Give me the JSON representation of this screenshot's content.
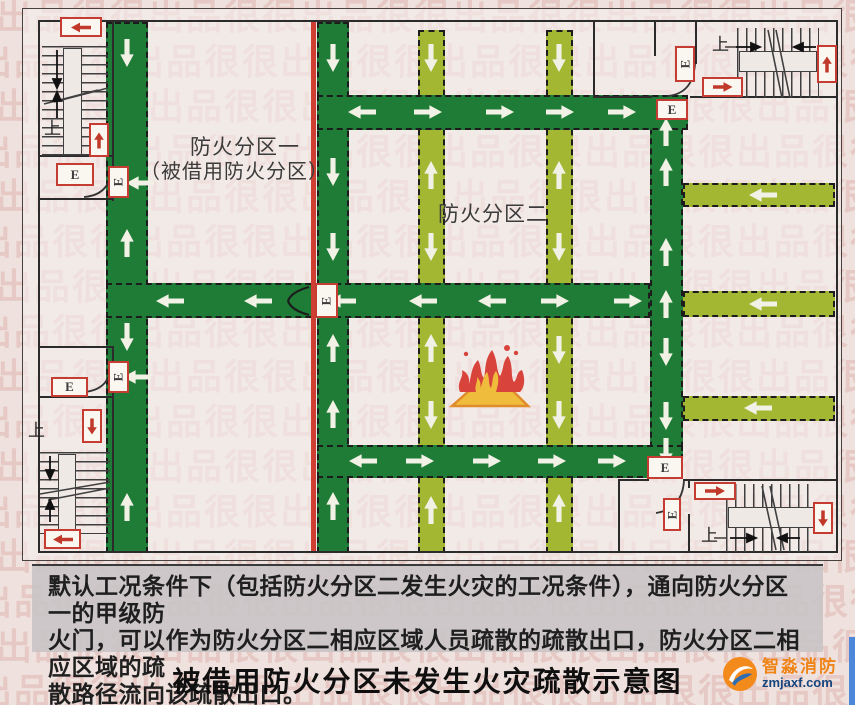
{
  "watermark": {
    "chars": "出品很很"
  },
  "caption": {
    "text": "被借用防火分区未发生火灾疏散示意图"
  },
  "note": {
    "lines": [
      "默认工况条件下（包括防火分区二发生火灾的工况条件），通向防火分区一的甲级防",
      "火门，可以作为防火分区二相应区域人员疏散的疏散出口，防火分区二相应区域的疏",
      "散路径流向该疏散出口。"
    ]
  },
  "logo": {
    "name": "智淼消防",
    "domain": "zmjaxf.com"
  },
  "plan": {
    "labels": {
      "zone1_line1": "防火分区一",
      "zone1_line2": "（被借用防火分区）",
      "zone2": "防火分区二",
      "up": "上",
      "exit": "E"
    },
    "colors": {
      "corridor_green": "#1f7c36",
      "corridor_olive": "#a4b733",
      "firewall_red": "#cf3e33",
      "sign_red": "#c0392b",
      "arrow_white": "#f2f1e6"
    },
    "firewall": {
      "x": 311,
      "y": 20,
      "w": 5,
      "h": 533
    },
    "corridors": [
      {
        "id": "olive-vertical-1",
        "color": "olive",
        "x": 418,
        "y": 30,
        "w": 27,
        "h": 523
      },
      {
        "id": "olive-vertical-2",
        "color": "olive",
        "x": 546,
        "y": 30,
        "w": 27,
        "h": 523
      },
      {
        "id": "olive-stub-upper",
        "color": "olive",
        "x": 683,
        "y": 183,
        "w": 152,
        "h": 24
      },
      {
        "id": "olive-stub-middle",
        "color": "olive",
        "x": 683,
        "y": 291,
        "w": 152,
        "h": 26
      },
      {
        "id": "olive-stub-lower",
        "color": "olive",
        "x": 683,
        "y": 396,
        "w": 152,
        "h": 25
      },
      {
        "id": "left-vertical",
        "color": "green",
        "x": 106,
        "y": 22,
        "w": 42,
        "h": 531
      },
      {
        "id": "firewall-vertical",
        "color": "green",
        "x": 317,
        "y": 22,
        "w": 32,
        "h": 531
      },
      {
        "id": "right-vertical",
        "color": "green",
        "x": 650,
        "y": 98,
        "w": 33,
        "h": 380
      },
      {
        "id": "top-horizontal",
        "color": "green",
        "x": 317,
        "y": 95,
        "w": 371,
        "h": 35
      },
      {
        "id": "middle-horizontal",
        "color": "green",
        "x": 106,
        "y": 283,
        "w": 544,
        "h": 35
      },
      {
        "id": "bottom-horizontal",
        "color": "green",
        "x": 317,
        "y": 445,
        "w": 366,
        "h": 33
      }
    ],
    "flow_arrows": [
      {
        "x": 127,
        "y": 53,
        "dir": "down"
      },
      {
        "x": 127,
        "y": 243,
        "dir": "up"
      },
      {
        "x": 127,
        "y": 337,
        "dir": "down"
      },
      {
        "x": 127,
        "y": 507,
        "dir": "up"
      },
      {
        "x": 140,
        "y": 183,
        "dir": "left"
      },
      {
        "x": 137,
        "y": 377,
        "dir": "left"
      },
      {
        "x": 333,
        "y": 58,
        "dir": "down"
      },
      {
        "x": 333,
        "y": 172,
        "dir": "down"
      },
      {
        "x": 333,
        "y": 247,
        "dir": "down"
      },
      {
        "x": 333,
        "y": 348,
        "dir": "up"
      },
      {
        "x": 333,
        "y": 414,
        "dir": "up"
      },
      {
        "x": 333,
        "y": 506,
        "dir": "up"
      },
      {
        "x": 362,
        "y": 112,
        "dir": "left"
      },
      {
        "x": 428,
        "y": 112,
        "dir": "right"
      },
      {
        "x": 500,
        "y": 112,
        "dir": "right"
      },
      {
        "x": 560,
        "y": 112,
        "dir": "right"
      },
      {
        "x": 622,
        "y": 112,
        "dir": "right"
      },
      {
        "x": 666,
        "y": 132,
        "dir": "up"
      },
      {
        "x": 666,
        "y": 172,
        "dir": "up"
      },
      {
        "x": 666,
        "y": 252,
        "dir": "up"
      },
      {
        "x": 666,
        "y": 304,
        "dir": "up"
      },
      {
        "x": 666,
        "y": 352,
        "dir": "down"
      },
      {
        "x": 666,
        "y": 416,
        "dir": "down"
      },
      {
        "x": 666,
        "y": 452,
        "dir": "down"
      },
      {
        "x": 170,
        "y": 301,
        "dir": "left"
      },
      {
        "x": 258,
        "y": 301,
        "dir": "left"
      },
      {
        "x": 342,
        "y": 301,
        "dir": "left"
      },
      {
        "x": 423,
        "y": 301,
        "dir": "left"
      },
      {
        "x": 492,
        "y": 301,
        "dir": "left"
      },
      {
        "x": 555,
        "y": 301,
        "dir": "right"
      },
      {
        "x": 628,
        "y": 301,
        "dir": "right"
      },
      {
        "x": 363,
        "y": 461,
        "dir": "left"
      },
      {
        "x": 420,
        "y": 461,
        "dir": "right"
      },
      {
        "x": 487,
        "y": 461,
        "dir": "right"
      },
      {
        "x": 552,
        "y": 461,
        "dir": "right"
      },
      {
        "x": 612,
        "y": 461,
        "dir": "right"
      },
      {
        "x": 431,
        "y": 58,
        "dir": "down"
      },
      {
        "x": 431,
        "y": 175,
        "dir": "up"
      },
      {
        "x": 431,
        "y": 247,
        "dir": "down"
      },
      {
        "x": 431,
        "y": 348,
        "dir": "up"
      },
      {
        "x": 431,
        "y": 415,
        "dir": "down"
      },
      {
        "x": 431,
        "y": 510,
        "dir": "up"
      },
      {
        "x": 559,
        "y": 58,
        "dir": "down"
      },
      {
        "x": 559,
        "y": 175,
        "dir": "up"
      },
      {
        "x": 559,
        "y": 247,
        "dir": "down"
      },
      {
        "x": 559,
        "y": 350,
        "dir": "down"
      },
      {
        "x": 559,
        "y": 415,
        "dir": "down"
      },
      {
        "x": 559,
        "y": 508,
        "dir": "up"
      },
      {
        "x": 763,
        "y": 195,
        "dir": "left"
      },
      {
        "x": 763,
        "y": 304,
        "dir": "left"
      },
      {
        "x": 758,
        "y": 408,
        "dir": "left"
      }
    ],
    "exit_doors": [
      {
        "x": 108,
        "y": 166,
        "w": 21,
        "h": 32,
        "rot": true
      },
      {
        "x": 108,
        "y": 361,
        "w": 21,
        "h": 32,
        "rot": true
      },
      {
        "x": 315,
        "y": 283,
        "w": 23,
        "h": 35,
        "rot": true
      },
      {
        "x": 656,
        "y": 99,
        "w": 32,
        "h": 21,
        "rot": false
      },
      {
        "x": 647,
        "y": 456,
        "w": 36,
        "h": 23,
        "rot": false
      }
    ],
    "exit_signs": [
      {
        "x": 56,
        "y": 163,
        "w": 38,
        "h": 23,
        "rot": false
      },
      {
        "x": 51,
        "y": 377,
        "w": 37,
        "h": 20,
        "rot": false
      },
      {
        "x": 675,
        "y": 46,
        "w": 20,
        "h": 36,
        "rot": true
      },
      {
        "x": 663,
        "y": 498,
        "w": 18,
        "h": 33,
        "rot": true
      }
    ],
    "direction_signs": [
      {
        "x": 60,
        "y": 17,
        "w": 42,
        "h": 20,
        "dir": "left"
      },
      {
        "x": 89,
        "y": 123,
        "w": 20,
        "h": 34,
        "dir": "up"
      },
      {
        "x": 82,
        "y": 409,
        "w": 20,
        "h": 34,
        "dir": "down"
      },
      {
        "x": 44,
        "y": 529,
        "w": 37,
        "h": 20,
        "dir": "left"
      },
      {
        "x": 702,
        "y": 77,
        "w": 41,
        "h": 20,
        "dir": "right"
      },
      {
        "x": 817,
        "y": 45,
        "w": 20,
        "h": 38,
        "dir": "up"
      },
      {
        "x": 694,
        "y": 482,
        "w": 42,
        "h": 18,
        "dir": "right"
      },
      {
        "x": 813,
        "y": 502,
        "w": 20,
        "h": 32,
        "dir": "down"
      }
    ]
  }
}
